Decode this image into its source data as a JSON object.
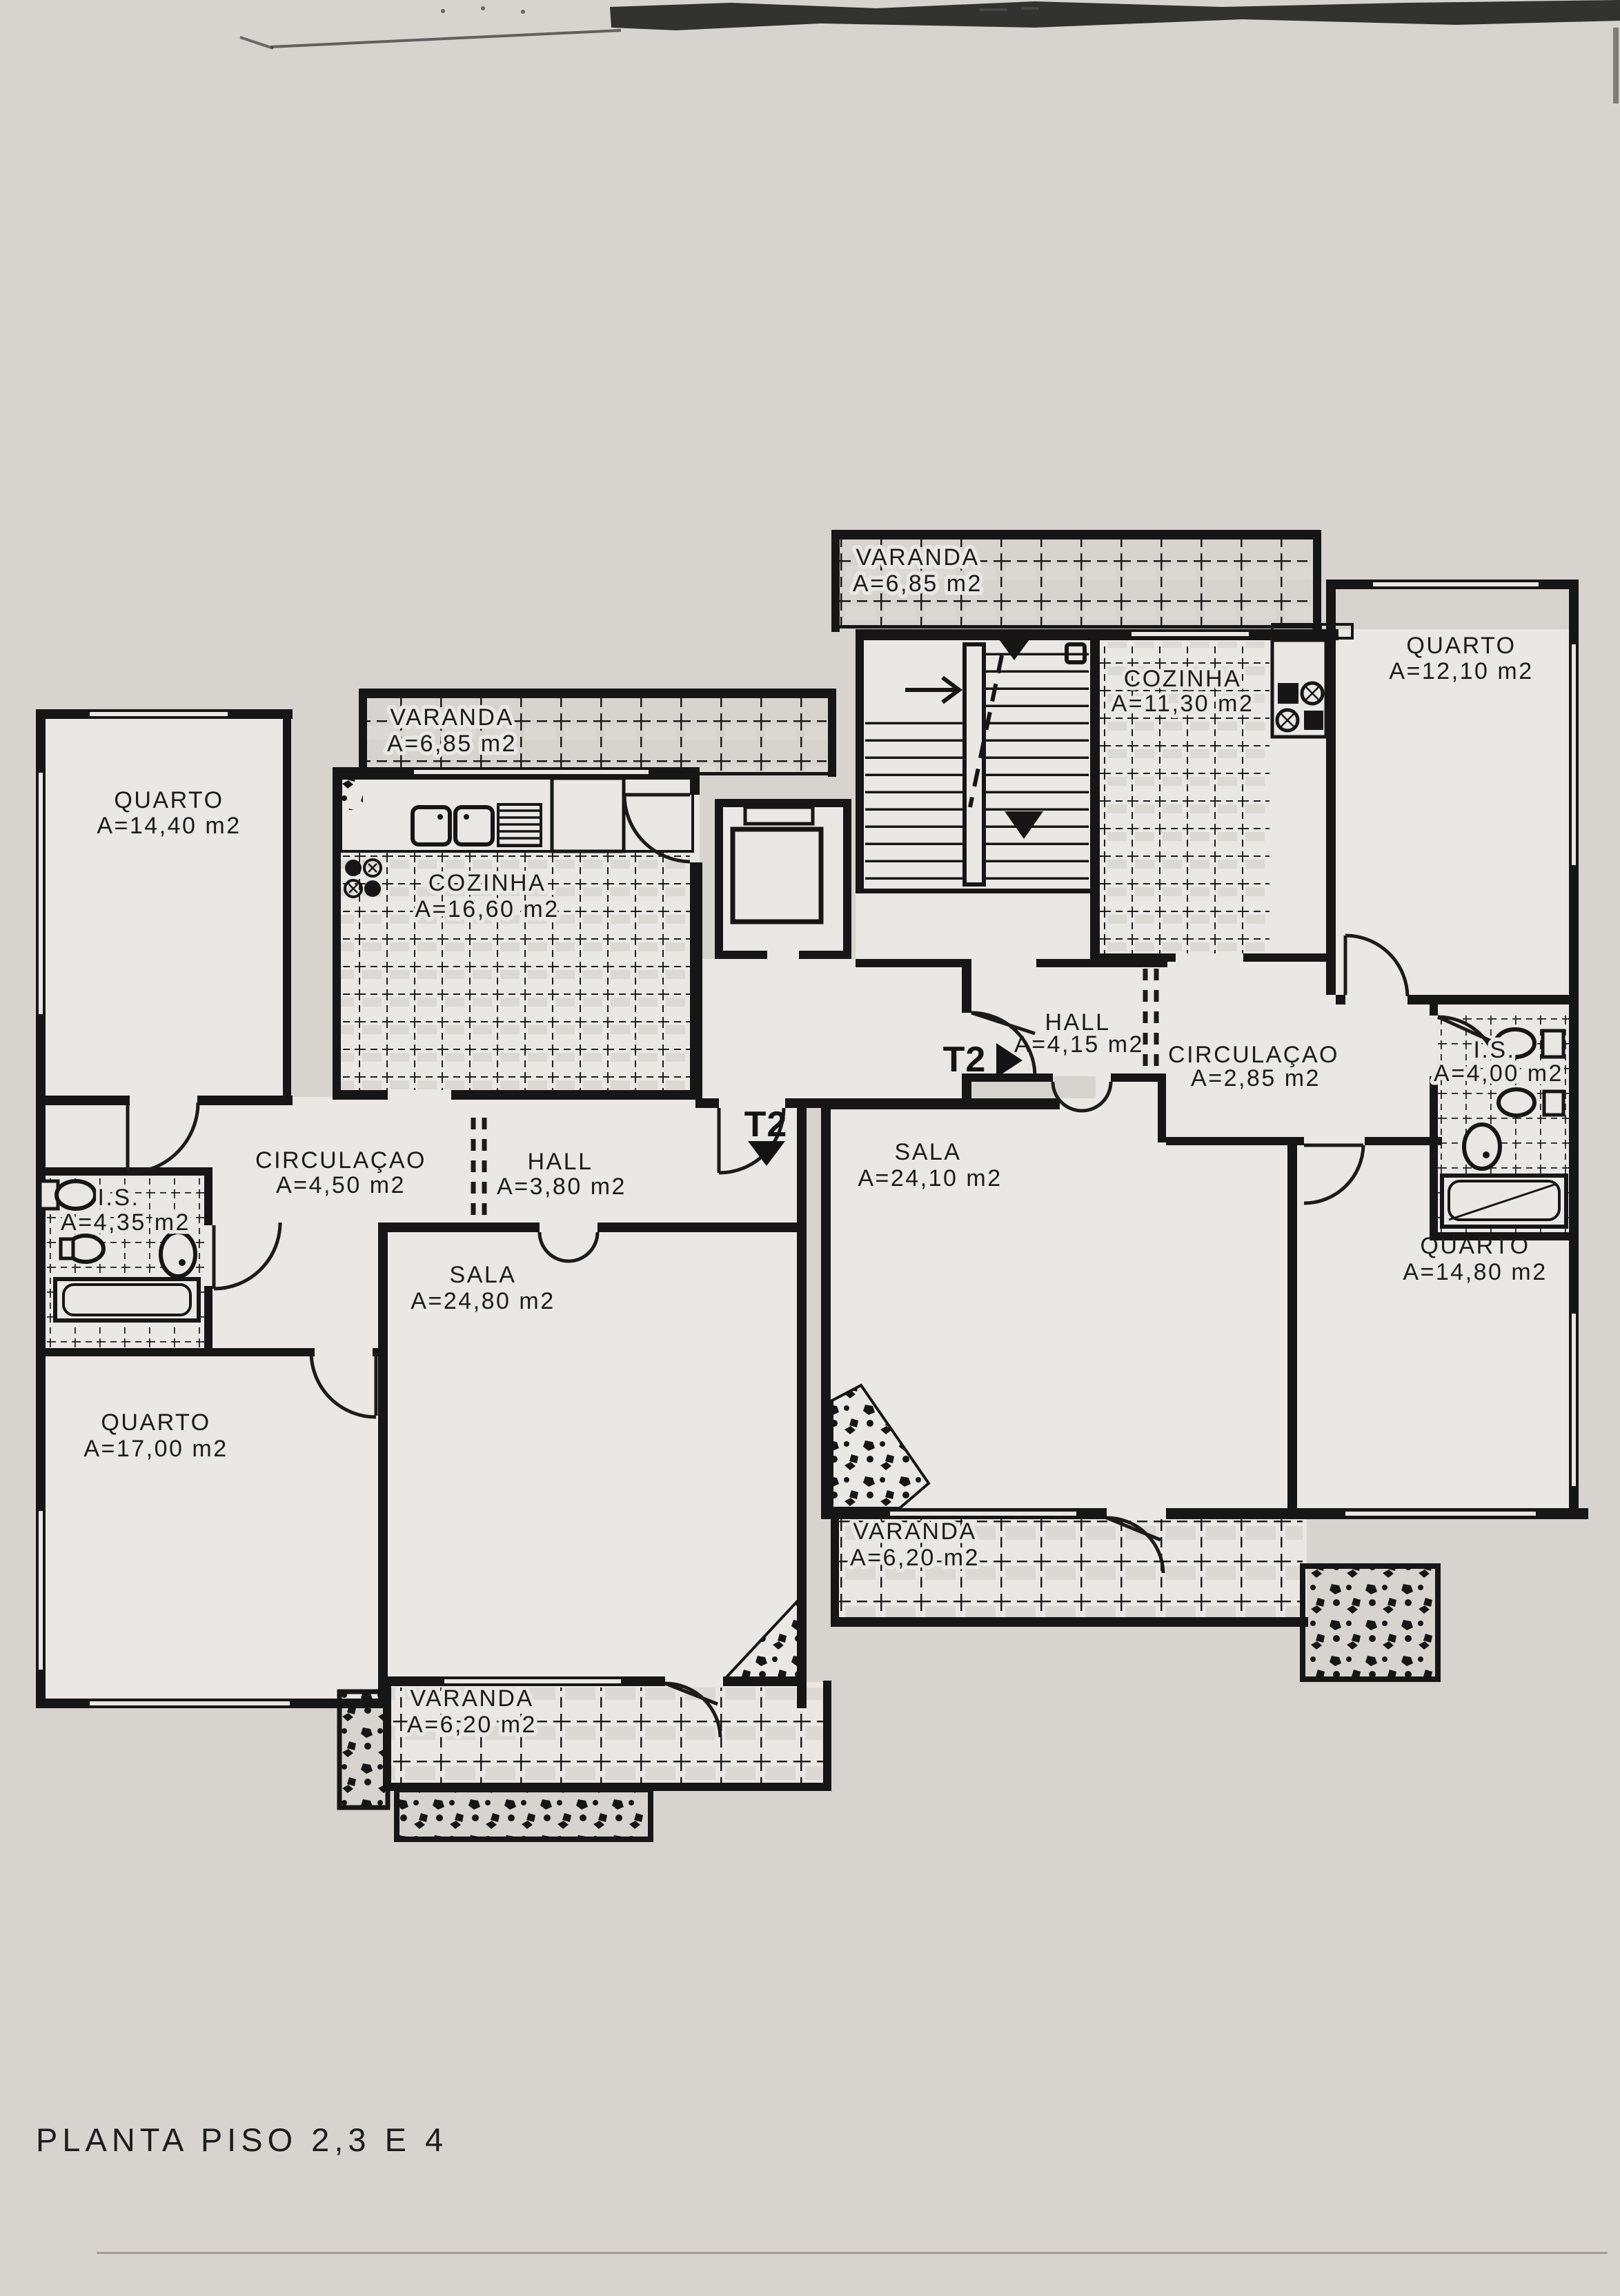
{
  "title": "PLANTA PISO 2,3 E 4",
  "plan_type": "floor-plan",
  "colors": {
    "paper": "#d7d4cf",
    "room": "#eae8e4",
    "ink": "#161616"
  },
  "apartments": {
    "left": {
      "entrance_marker": {
        "label": "T2",
        "direction": "down"
      },
      "rooms": [
        {
          "name": "QUARTO",
          "area": "A=14,40 m2"
        },
        {
          "name": "VARANDA",
          "area": "A=6,85 m2"
        },
        {
          "name": "COZINHA",
          "area": "A=16,60 m2"
        },
        {
          "name": "CIRCULAÇAO",
          "area": "A=4,50 m2"
        },
        {
          "name": "HALL",
          "area": "A=3,80 m2"
        },
        {
          "name": "I.S.",
          "area": "A=4,35 m2"
        },
        {
          "name": "SALA",
          "area": "A=24,80 m2"
        },
        {
          "name": "QUARTO",
          "area": "A=17,00 m2"
        },
        {
          "name": "VARANDA",
          "area": "A=6,20 m2"
        }
      ]
    },
    "right": {
      "entrance_marker": {
        "label": "T2",
        "direction": "right"
      },
      "rooms": [
        {
          "name": "VARANDA",
          "area": "A=6,85 m2"
        },
        {
          "name": "COZINHA",
          "area": "A=11,30 m2"
        },
        {
          "name": "QUARTO",
          "area": "A=12,10 m2"
        },
        {
          "name": "HALL",
          "area": "A=4,15 m2"
        },
        {
          "name": "CIRCULAÇAO",
          "area": "A=2,85 m2"
        },
        {
          "name": "I.S.",
          "area": "A=4,00 m2"
        },
        {
          "name": "SALA",
          "area": "A=24,10 m2"
        },
        {
          "name": "QUARTO",
          "area": "A=14,80 m2"
        },
        {
          "name": "VARANDA",
          "area": "A=6,20 m2"
        }
      ]
    }
  }
}
